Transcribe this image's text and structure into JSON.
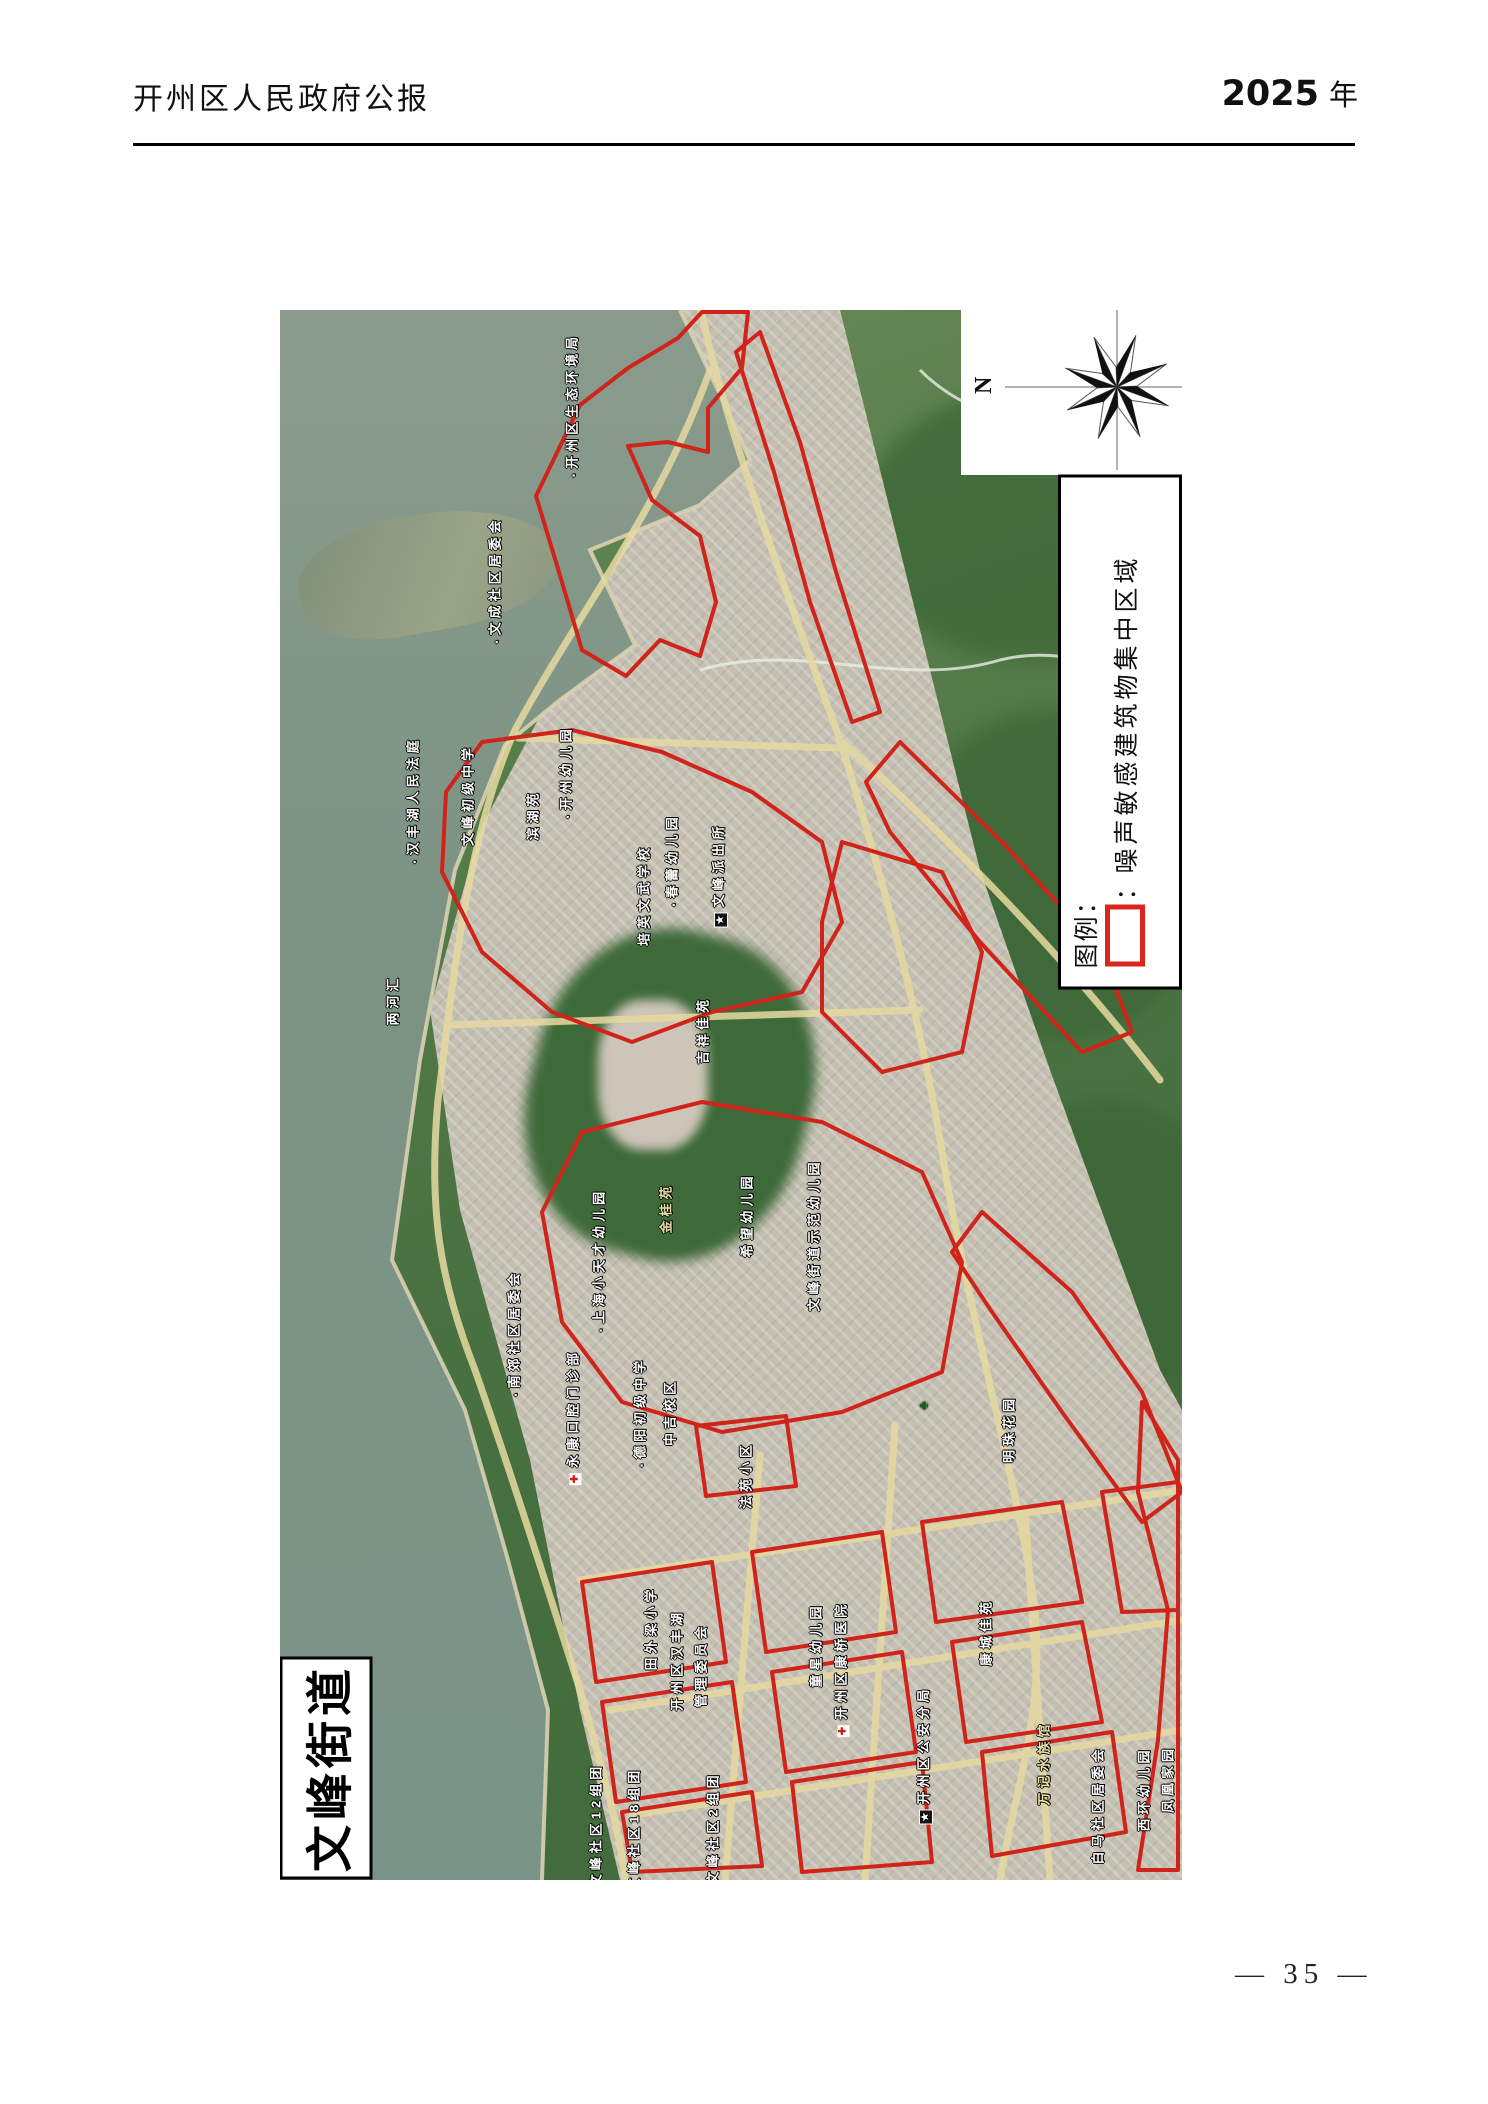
{
  "page": {
    "header_left": "开州区人民政府公报",
    "header_right_number": "2025",
    "header_right_unit": "年",
    "page_number": "— 35 —"
  },
  "map": {
    "title": "文峰街道",
    "compass": {
      "north_label": "N"
    },
    "legend": {
      "title": "图例：",
      "items": [
        {
          "symbol": "red-rectangle",
          "symbol_color": "#da251c",
          "separator": "：",
          "label": "噪声敏感建筑物集中区域"
        }
      ]
    },
    "labels": [
      {
        "t": "开州区生态环境局",
        "x": 291,
        "y": 95,
        "icon": "dot"
      },
      {
        "t": "文成社区居委会",
        "x": 214,
        "y": 270,
        "icon": "dot"
      },
      {
        "t": "汉丰湖人民法庭",
        "x": 132,
        "y": 490,
        "icon": "dot"
      },
      {
        "t": "文峰初级中学",
        "x": 187,
        "y": 485
      },
      {
        "t": "滨湖苑",
        "x": 252,
        "y": 505
      },
      {
        "t": "开州幼儿园",
        "x": 285,
        "y": 462,
        "icon": "dot"
      },
      {
        "t": "春蕾幼儿园",
        "x": 391,
        "y": 550,
        "icon": "dot"
      },
      {
        "t": "培英文武学校",
        "x": 363,
        "y": 585
      },
      {
        "t": "文峰派出所",
        "x": 438,
        "y": 565,
        "icon": "star"
      },
      {
        "t": "两河汇",
        "x": 112,
        "y": 690
      },
      {
        "t": "吉祥佳苑",
        "x": 422,
        "y": 720
      },
      {
        "t": "南郊社区居委会",
        "x": 233,
        "y": 1023,
        "icon": "dot"
      },
      {
        "t": "上海小天才幼儿园",
        "x": 318,
        "y": 950,
        "icon": "dot"
      },
      {
        "t": "金桂苑",
        "x": 385,
        "y": 898,
        "style": "gold"
      },
      {
        "t": "希望幼儿园",
        "x": 466,
        "y": 905
      },
      {
        "t": "文峰街道示范幼儿园",
        "x": 533,
        "y": 925
      },
      {
        "t": "德阳初级中学",
        "x": 359,
        "y": 1102,
        "icon": "dot"
      },
      {
        "t": "中吉校区",
        "x": 389,
        "y": 1102
      },
      {
        "t": "永康口腔门诊部",
        "x": 292,
        "y": 1107,
        "icon": "cross"
      },
      {
        "t": "法苑小区",
        "x": 465,
        "y": 1165
      },
      {
        "t": "明珠花园",
        "x": 728,
        "y": 1119
      },
      {
        "t": "",
        "x": 643,
        "y": 1093,
        "icon": "tree"
      },
      {
        "t": "田外梁小学",
        "x": 370,
        "y": 1318
      },
      {
        "t": "开州区汉丰湖",
        "x": 396,
        "y": 1350
      },
      {
        "t": "管理委员会",
        "x": 420,
        "y": 1355
      },
      {
        "t": "童星幼儿园",
        "x": 535,
        "y": 1335
      },
      {
        "t": "开州区康桥医院",
        "x": 560,
        "y": 1359,
        "icon": "cross"
      },
      {
        "t": "开州区公安分局",
        "x": 643,
        "y": 1445,
        "icon": "star"
      },
      {
        "t": "康城佳苑",
        "x": 705,
        "y": 1322
      },
      {
        "t": "文峰社区12组团",
        "x": 315,
        "y": 1515
      },
      {
        "t": "文峰社区18组团",
        "x": 353,
        "y": 1519
      },
      {
        "t": "文峰社区2组团",
        "x": 432,
        "y": 1518
      },
      {
        "t": "万记水族馆",
        "x": 763,
        "y": 1453,
        "style": "gold"
      },
      {
        "t": "白马社区居委会",
        "x": 817,
        "y": 1495
      },
      {
        "t": "西环幼儿园",
        "x": 863,
        "y": 1479
      },
      {
        "t": "凤凰家园",
        "x": 887,
        "y": 1469
      }
    ]
  },
  "colors": {
    "boundary_red": "#d0231a",
    "legend_red": "#da251c",
    "road_yellow": "#e6daa0",
    "water_green": "#7e9486"
  }
}
